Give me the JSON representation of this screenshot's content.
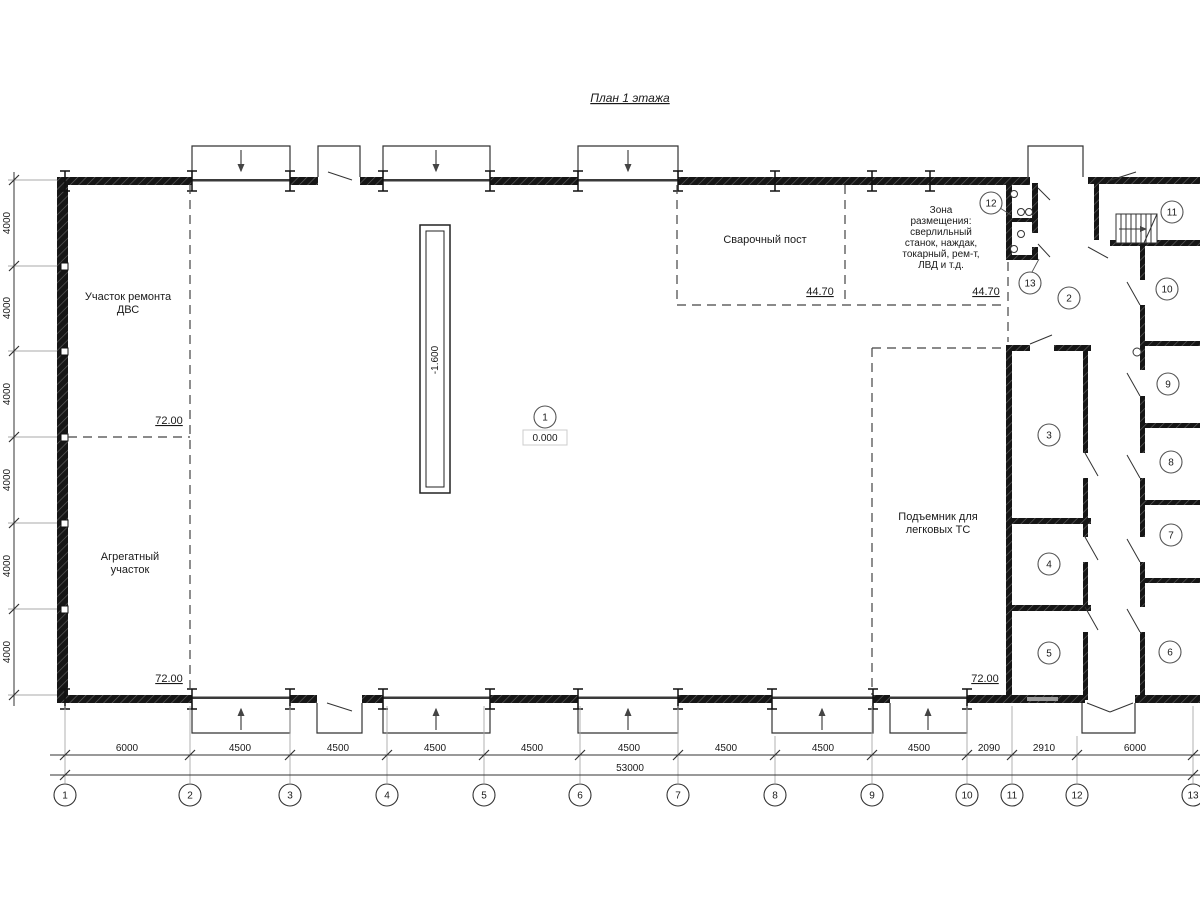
{
  "title": "План 1 этажа",
  "zones": {
    "engine_repair": {
      "line1": "Участок ремонта",
      "line2": "ДВС",
      "area": "72.00"
    },
    "aggregate": {
      "line1": "Агрегатный",
      "line2": "участок",
      "area": "72.00"
    },
    "welding": {
      "label": "Сварочный пост",
      "area": "44.70"
    },
    "equipment": {
      "lines": [
        "Зона",
        "размещения:",
        "сверлильный",
        "станок, наждак,",
        "токарный, рем-т,",
        "ЛВД и т.д."
      ],
      "area": "44.70"
    },
    "car_lift": {
      "line1": "Подъемник для",
      "line2": "легковых ТС",
      "area": "72.00"
    }
  },
  "elevations": {
    "pit": "-1.600",
    "floor": "0.000"
  },
  "rooms": [
    "1",
    "2",
    "3",
    "4",
    "5",
    "6",
    "7",
    "8",
    "9",
    "10",
    "11",
    "12",
    "13"
  ],
  "grid_bubbles": [
    "1",
    "2",
    "3",
    "4",
    "5",
    "6",
    "7",
    "8",
    "9",
    "10",
    "11",
    "12",
    "13"
  ],
  "dims": {
    "bottom": [
      "6000",
      "4500",
      "4500",
      "4500",
      "4500",
      "4500",
      "4500",
      "4500",
      "4500",
      "2090",
      "2910",
      "6000"
    ],
    "total": "53000",
    "left": [
      "4000",
      "4000",
      "4000",
      "4000",
      "4000",
      "4000"
    ]
  }
}
